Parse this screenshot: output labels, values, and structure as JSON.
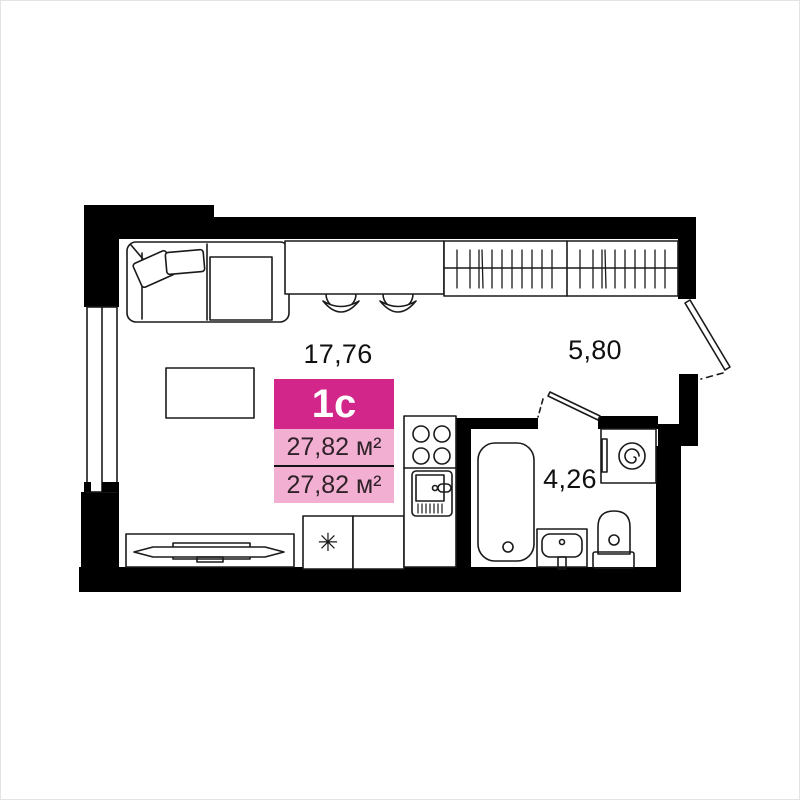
{
  "plan": {
    "unit_badge": {
      "type_label": "1с",
      "total_area": "27,82 м²",
      "living_area": "27,82 м²",
      "colors": {
        "header_bg": "#d2268a",
        "rows_bg": "#f2afd2",
        "header_text": "#ffffff",
        "rows_text": "#2e2228",
        "divider": "#141414"
      }
    },
    "room_areas": {
      "living_kitchen": "17,76",
      "hallway": "5,80",
      "bathroom": "4,26"
    },
    "symbols": {
      "fridge_star": "✳"
    },
    "wall_color": "#000000",
    "background": "#ffffff",
    "furniture_icons": [
      "sofa-icon",
      "bar-counter-icon",
      "bar-stool-icon",
      "wardrobe-icon",
      "coffee-table-icon",
      "tv-stand-icon",
      "tv-icon",
      "fridge-icon",
      "kitchen-cabinet-icon",
      "stove-icon",
      "kitchen-sink-icon",
      "bathtub-icon",
      "washing-machine-icon",
      "bathroom-sink-icon",
      "toilet-icon",
      "window-icon",
      "entrance-door-icon",
      "bathroom-door-icon"
    ]
  }
}
